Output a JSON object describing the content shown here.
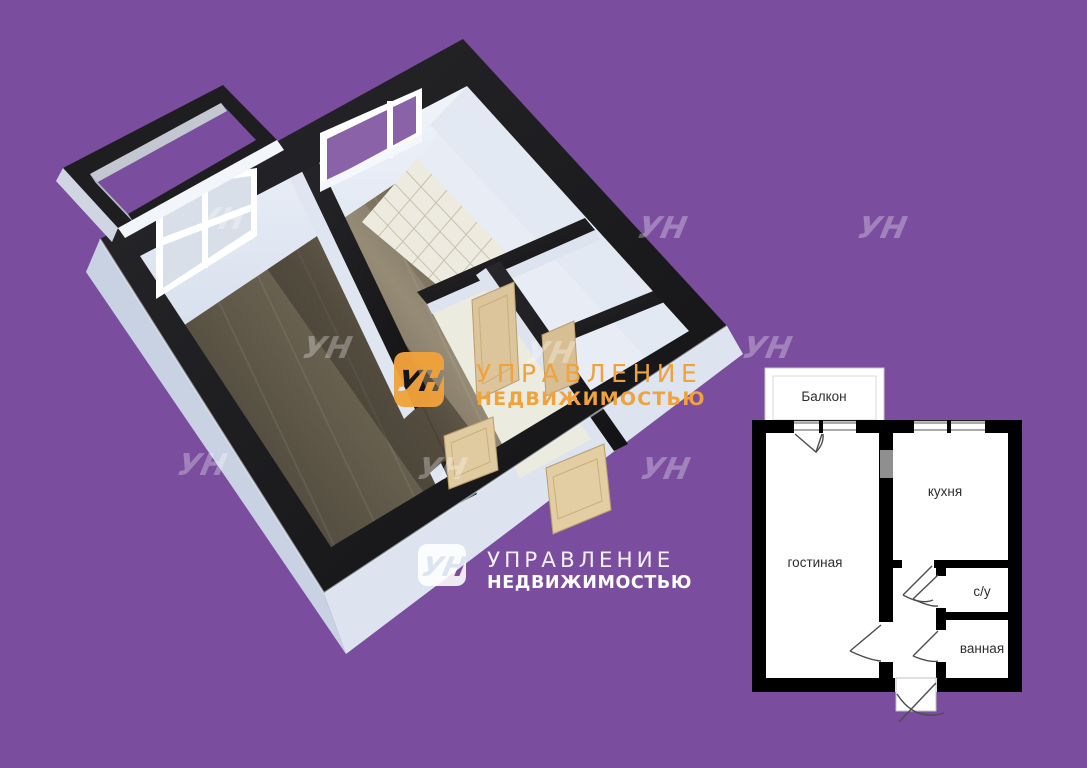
{
  "background": {
    "color": "#7A4D9E"
  },
  "brand": {
    "monogram": "УН",
    "name_line1": "УПРАВЛЕНИЕ",
    "name_line2": "НЕДВИЖИМОСТЬЮ",
    "accent_orange": "#F0A23C",
    "logo_white": "#FFFFFF"
  },
  "watermark": {
    "glyph": "УН"
  },
  "floorplan_2d": {
    "wall_color": "#000000",
    "floor_color": "#FFFFFF",
    "rooms": [
      {
        "id": "balcony",
        "label": "Балкон"
      },
      {
        "id": "living",
        "label": "гостиная"
      },
      {
        "id": "kitchen",
        "label": "кухня"
      },
      {
        "id": "wc",
        "label": "с/у"
      },
      {
        "id": "bathroom",
        "label": "ванная"
      }
    ]
  },
  "render_3d": {
    "wood_floor_color": "#6E6553",
    "tile_floor_color": "#EDEBDF",
    "wall_top_color": "#1D1D20",
    "slab_side_color": "#CDD5E3",
    "door_color": "#DCC59B"
  }
}
